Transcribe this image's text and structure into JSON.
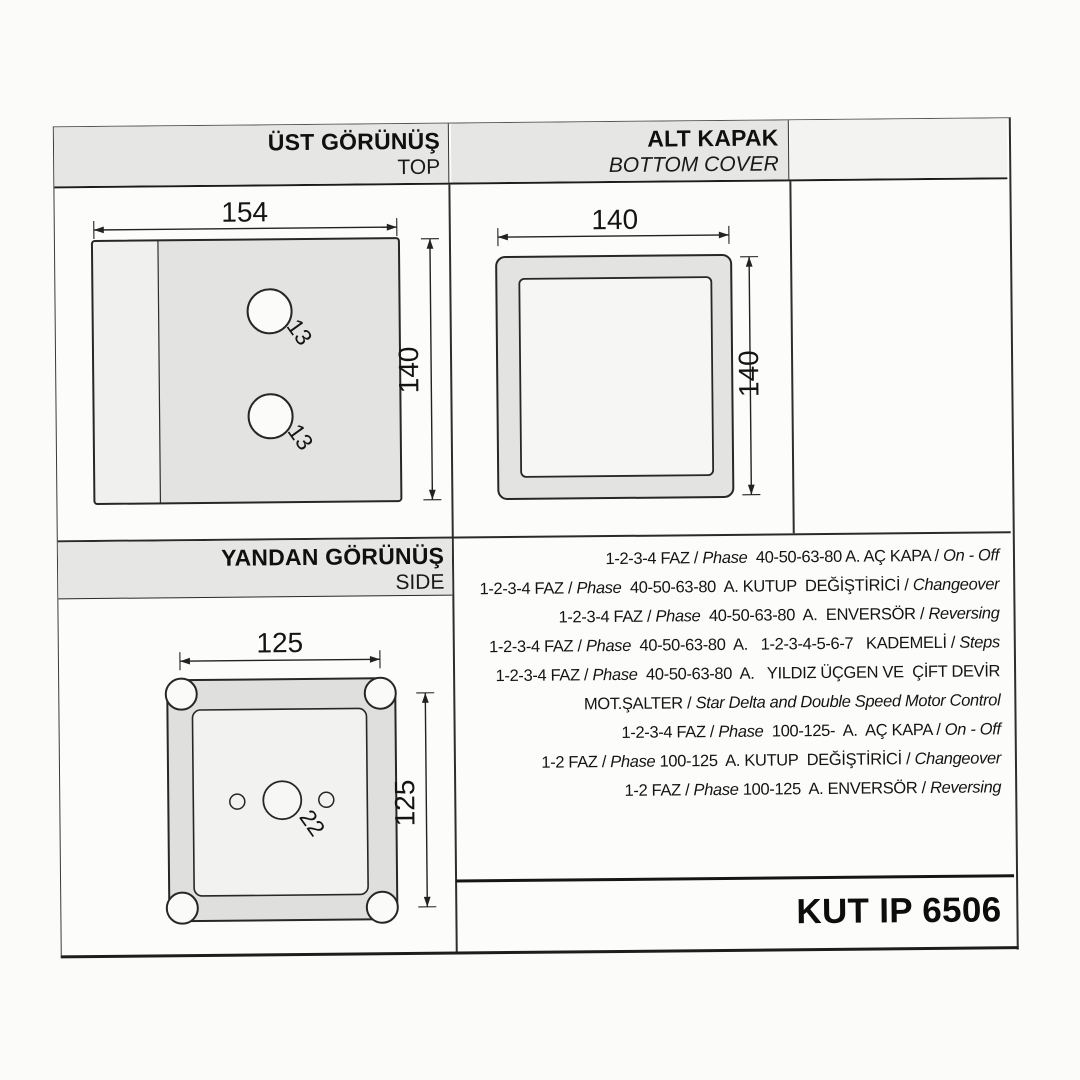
{
  "panels": {
    "top_view": {
      "title_tr": "ÜST GÖRÜNÜŞ",
      "title_en": "TOP",
      "dim_width": "154",
      "dim_height": "140",
      "hole1_label": "13",
      "hole2_label": "13"
    },
    "bottom_cover": {
      "title_tr": "ALT KAPAK",
      "title_en": "BOTTOM COVER",
      "dim_width": "140",
      "dim_height": "140"
    },
    "side_view": {
      "title_tr": "YANDAN GÖRÜNÜŞ",
      "title_en": "SIDE",
      "dim_width": "125",
      "dim_height": "125",
      "hole_label": "22"
    }
  },
  "spec_lines": [
    [
      {
        "t": "1-2-3-4 FAZ / "
      },
      {
        "t": "Phase",
        "i": true
      },
      {
        "t": "  40-50-63-80 A. AÇ KAPA / "
      },
      {
        "t": "On - Off",
        "i": true
      }
    ],
    [
      {
        "t": "1-2-3-4 FAZ / "
      },
      {
        "t": "Phase",
        "i": true
      },
      {
        "t": "  40-50-63-80  A. KUTUP  DEĞİŞTİRİCİ / "
      },
      {
        "t": "Changeover",
        "i": true
      }
    ],
    [
      {
        "t": "1-2-3-4 FAZ / "
      },
      {
        "t": "Phase",
        "i": true
      },
      {
        "t": "  40-50-63-80  A.  ENVERSÖR / "
      },
      {
        "t": "Reversing",
        "i": true
      }
    ],
    [
      {
        "t": "1-2-3-4 FAZ / "
      },
      {
        "t": "Phase",
        "i": true
      },
      {
        "t": "  40-50-63-80  A.   1-2-3-4-5-6-7   KADEMELİ / "
      },
      {
        "t": "Steps",
        "i": true
      }
    ],
    [
      {
        "t": "1-2-3-4 FAZ / "
      },
      {
        "t": "Phase",
        "i": true
      },
      {
        "t": "  40-50-63-80  A.   YILDIZ ÜÇGEN VE  ÇİFT DEVİR"
      }
    ],
    [
      {
        "t": "MOT.ŞALTER / "
      },
      {
        "t": "Star Delta and Double Speed Motor Control",
        "i": true
      }
    ],
    [
      {
        "t": "1-2-3-4 FAZ / "
      },
      {
        "t": "Phase",
        "i": true
      },
      {
        "t": "  100-125-  A.  AÇ KAPA / "
      },
      {
        "t": "On - Off",
        "i": true
      }
    ],
    [
      {
        "t": "1-2 FAZ / "
      },
      {
        "t": "Phase",
        "i": true
      },
      {
        "t": " 100-125  A. KUTUP  DEĞİŞTİRİCİ / "
      },
      {
        "t": "Changeover",
        "i": true
      }
    ],
    [
      {
        "t": "1-2 FAZ / "
      },
      {
        "t": "Phase",
        "i": true
      },
      {
        "t": " 100-125  A. ENVERSÖR / "
      },
      {
        "t": "Reversing",
        "i": true
      }
    ]
  ],
  "footer": {
    "model": "KUT IP 6506"
  },
  "colors": {
    "band_gray": "#e6e6e4",
    "fill_gray": "#e3e3e1",
    "line_black": "#262626",
    "paper": "#fbfbfa"
  }
}
